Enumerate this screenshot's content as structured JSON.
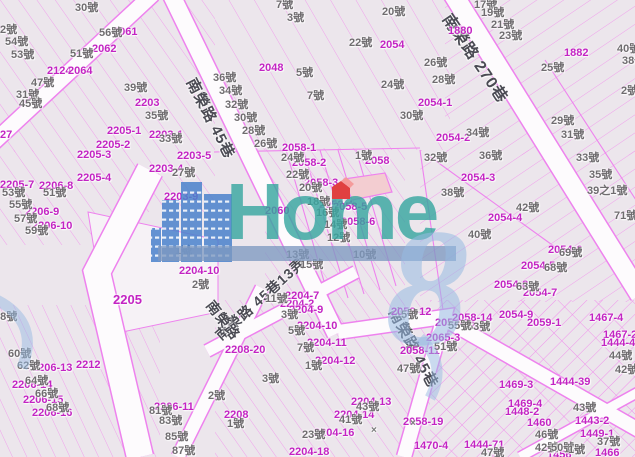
{
  "map": {
    "colors": {
      "background": "#ece6ec",
      "parcel_line": "#f0a0ec",
      "road_edge": "#ee82ee",
      "road_fill": "#fdfbfd",
      "parcel_label": "#c324c3",
      "house_label": "#6f6c6f",
      "street_label": "#4b4b54",
      "marker_red": "#e04040",
      "highlight_parcel_fill": "#f3cdd1"
    },
    "watermark": {
      "text": "Home",
      "numeral": "8",
      "text_color": "rgba(56,166,160,0.82)",
      "bar_color": "rgba(125,152,192,0.78)",
      "numeral_color": "rgba(152,186,226,0.55)",
      "building_color": "#4a82cc"
    },
    "street_labels": [
      {
        "text": "南榮路 45巷",
        "x": 197,
        "y": 76,
        "rot": 63,
        "size": 15
      },
      {
        "text": "南榮路 270巷",
        "x": 452,
        "y": 12,
        "rot": 56,
        "size": 16
      },
      {
        "text": "南榮路 45巷13弄",
        "x": 213,
        "y": 332,
        "rot": -42,
        "size": 14
      },
      {
        "text": "南榮路",
        "x": 215,
        "y": 298,
        "rot": 52,
        "size": 14
      },
      {
        "text": "南榮路 45巷",
        "x": 399,
        "y": 306,
        "rot": 62,
        "size": 15
      }
    ],
    "parcel_labels": [
      {
        "text": "2061",
        "x": 113,
        "y": 27
      },
      {
        "text": "2062",
        "x": 92,
        "y": 44
      },
      {
        "text": "2124",
        "x": 47,
        "y": 66
      },
      {
        "text": "2064",
        "x": 68,
        "y": 66
      },
      {
        "text": "2203",
        "x": 135,
        "y": 98
      },
      {
        "text": "2205-1",
        "x": 107,
        "y": 126
      },
      {
        "text": "2203-1",
        "x": 149,
        "y": 130
      },
      {
        "text": "2205-2",
        "x": 96,
        "y": 140
      },
      {
        "text": "27",
        "x": 0,
        "y": 130
      },
      {
        "text": "2048",
        "x": 259,
        "y": 63
      },
      {
        "text": "2054",
        "x": 380,
        "y": 40
      },
      {
        "text": "2054-1",
        "x": 418,
        "y": 98
      },
      {
        "text": "2058-1",
        "x": 282,
        "y": 143
      },
      {
        "text": "1880",
        "x": 448,
        "y": 26
      },
      {
        "text": "1882",
        "x": 564,
        "y": 48
      },
      {
        "text": "2054-2",
        "x": 436,
        "y": 133
      },
      {
        "text": "2054-3",
        "x": 461,
        "y": 173
      },
      {
        "text": "2054-4",
        "x": 488,
        "y": 213
      },
      {
        "text": "2054-6",
        "x": 548,
        "y": 245
      },
      {
        "text": "2054-5",
        "x": 521,
        "y": 261
      },
      {
        "text": "2054-8",
        "x": 494,
        "y": 280
      },
      {
        "text": "2054-7",
        "x": 523,
        "y": 288
      },
      {
        "text": "2205-3",
        "x": 77,
        "y": 150
      },
      {
        "text": "2205-4",
        "x": 77,
        "y": 173
      },
      {
        "text": "2205-7",
        "x": 0,
        "y": 180
      },
      {
        "text": "2206-8",
        "x": 39,
        "y": 181
      },
      {
        "text": "2206-9",
        "x": 25,
        "y": 207
      },
      {
        "text": "2206-10",
        "x": 32,
        "y": 221
      },
      {
        "text": "2203-4",
        "x": 149,
        "y": 164
      },
      {
        "text": "2203-5",
        "x": 177,
        "y": 151
      },
      {
        "text": "2203-9",
        "x": 164,
        "y": 192
      },
      {
        "text": "2058-2",
        "x": 292,
        "y": 158
      },
      {
        "text": "2058-3",
        "x": 304,
        "y": 178
      },
      {
        "text": "2058-4",
        "x": 319,
        "y": 200
      },
      {
        "text": "2058-5",
        "x": 333,
        "y": 202
      },
      {
        "text": "2058-6",
        "x": 341,
        "y": 217
      },
      {
        "text": "2058",
        "x": 365,
        "y": 156
      },
      {
        "text": "2060",
        "x": 265,
        "y": 206
      },
      {
        "text": "2204-10",
        "x": 179,
        "y": 266
      },
      {
        "text": "2205",
        "x": 113,
        "y": 293,
        "size": 13
      },
      {
        "text": "2212",
        "x": 76,
        "y": 360
      },
      {
        "text": "2206-13",
        "x": 32,
        "y": 363
      },
      {
        "text": "2206-14",
        "x": 12,
        "y": 380
      },
      {
        "text": "2206-15",
        "x": 23,
        "y": 395
      },
      {
        "text": "2206-16",
        "x": 32,
        "y": 408
      },
      {
        "text": "2206-11",
        "x": 154,
        "y": 402
      },
      {
        "text": "2208-20",
        "x": 225,
        "y": 345
      },
      {
        "text": "2208",
        "x": 224,
        "y": 410
      },
      {
        "text": "2204-2",
        "x": 280,
        "y": 299
      },
      {
        "text": "2204-7",
        "x": 285,
        "y": 291
      },
      {
        "text": "2204-9",
        "x": 289,
        "y": 305
      },
      {
        "text": "2204-10",
        "x": 297,
        "y": 321
      },
      {
        "text": "2204-11",
        "x": 307,
        "y": 338
      },
      {
        "text": "2204-12",
        "x": 315,
        "y": 356
      },
      {
        "text": "2204-13",
        "x": 351,
        "y": 397
      },
      {
        "text": "2204-14",
        "x": 334,
        "y": 410
      },
      {
        "text": "2204-16",
        "x": 314,
        "y": 428
      },
      {
        "text": "2204-18",
        "x": 289,
        "y": 447
      },
      {
        "text": "2058-19",
        "x": 403,
        "y": 417
      },
      {
        "text": "2058-12",
        "x": 391,
        "y": 307
      },
      {
        "text": "2058-13",
        "x": 435,
        "y": 318
      },
      {
        "text": "2058-14",
        "x": 452,
        "y": 313
      },
      {
        "text": "2058-11",
        "x": 400,
        "y": 346
      },
      {
        "text": "2065-3",
        "x": 426,
        "y": 333
      },
      {
        "text": "2054-9",
        "x": 499,
        "y": 310
      },
      {
        "text": "2059-1",
        "x": 527,
        "y": 318
      },
      {
        "text": "1467-4",
        "x": 589,
        "y": 313
      },
      {
        "text": "1467-2",
        "x": 603,
        "y": 330
      },
      {
        "text": "1444-4",
        "x": 601,
        "y": 338
      },
      {
        "text": "1469-3",
        "x": 499,
        "y": 380
      },
      {
        "text": "1444-39",
        "x": 550,
        "y": 377
      },
      {
        "text": "1469-4",
        "x": 508,
        "y": 399
      },
      {
        "text": "1448-2",
        "x": 505,
        "y": 407
      },
      {
        "text": "1460",
        "x": 527,
        "y": 418
      },
      {
        "text": "1443-2",
        "x": 575,
        "y": 416
      },
      {
        "text": "1449-1",
        "x": 580,
        "y": 429
      },
      {
        "text": "1444-71",
        "x": 464,
        "y": 440
      },
      {
        "text": "1470-4",
        "x": 414,
        "y": 441
      },
      {
        "text": "1456",
        "x": 547,
        "y": 450
      },
      {
        "text": "1466",
        "x": 595,
        "y": 448
      }
    ],
    "house_labels": [
      {
        "text": "30號",
        "x": 75,
        "y": 3
      },
      {
        "text": "2號",
        "x": 0,
        "y": 25
      },
      {
        "text": "54號",
        "x": 5,
        "y": 37
      },
      {
        "text": "53號",
        "x": 11,
        "y": 50
      },
      {
        "text": "56號",
        "x": 99,
        "y": 28
      },
      {
        "text": "51號",
        "x": 70,
        "y": 49
      },
      {
        "text": "47號",
        "x": 31,
        "y": 78
      },
      {
        "text": "31號",
        "x": 16,
        "y": 90
      },
      {
        "text": "45號",
        "x": 19,
        "y": 99
      },
      {
        "text": "39號",
        "x": 124,
        "y": 83
      },
      {
        "text": "35號",
        "x": 145,
        "y": 111
      },
      {
        "text": "33號",
        "x": 159,
        "y": 134
      },
      {
        "text": "27號",
        "x": 172,
        "y": 168
      },
      {
        "text": "7號",
        "x": 276,
        "y": 0
      },
      {
        "text": "3號",
        "x": 287,
        "y": 13
      },
      {
        "text": "20號",
        "x": 382,
        "y": 7
      },
      {
        "text": "22號",
        "x": 349,
        "y": 38
      },
      {
        "text": "26號",
        "x": 424,
        "y": 58
      },
      {
        "text": "24號",
        "x": 381,
        "y": 80
      },
      {
        "text": "28號",
        "x": 432,
        "y": 75
      },
      {
        "text": "30號",
        "x": 400,
        "y": 111
      },
      {
        "text": "5號",
        "x": 296,
        "y": 68
      },
      {
        "text": "7號",
        "x": 307,
        "y": 91
      },
      {
        "text": "36號",
        "x": 213,
        "y": 73
      },
      {
        "text": "34號",
        "x": 219,
        "y": 86
      },
      {
        "text": "32號",
        "x": 225,
        "y": 100
      },
      {
        "text": "30號",
        "x": 234,
        "y": 113
      },
      {
        "text": "28號",
        "x": 242,
        "y": 126
      },
      {
        "text": "26號",
        "x": 254,
        "y": 139
      },
      {
        "text": "17號",
        "x": 474,
        "y": 0
      },
      {
        "text": "19號",
        "x": 481,
        "y": 8
      },
      {
        "text": "21號",
        "x": 491,
        "y": 20
      },
      {
        "text": "23號",
        "x": 499,
        "y": 31
      },
      {
        "text": "25號",
        "x": 541,
        "y": 63
      },
      {
        "text": "34號",
        "x": 466,
        "y": 128
      },
      {
        "text": "29號",
        "x": 551,
        "y": 116
      },
      {
        "text": "31號",
        "x": 561,
        "y": 130
      },
      {
        "text": "33號",
        "x": 576,
        "y": 153
      },
      {
        "text": "35號",
        "x": 589,
        "y": 170
      },
      {
        "text": "39之1號",
        "x": 587,
        "y": 186
      },
      {
        "text": "71號",
        "x": 614,
        "y": 211
      },
      {
        "text": "2號",
        "x": 621,
        "y": 86
      },
      {
        "text": "40號",
        "x": 617,
        "y": 44
      },
      {
        "text": "38號",
        "x": 622,
        "y": 56
      },
      {
        "text": "32號",
        "x": 424,
        "y": 153
      },
      {
        "text": "36號",
        "x": 479,
        "y": 151
      },
      {
        "text": "38號",
        "x": 441,
        "y": 188
      },
      {
        "text": "42號",
        "x": 516,
        "y": 203
      },
      {
        "text": "40號",
        "x": 468,
        "y": 230
      },
      {
        "text": "69號",
        "x": 559,
        "y": 248
      },
      {
        "text": "68號",
        "x": 544,
        "y": 263
      },
      {
        "text": "63號",
        "x": 516,
        "y": 282
      },
      {
        "text": "53號",
        "x": 2,
        "y": 188
      },
      {
        "text": "51號",
        "x": 43,
        "y": 188
      },
      {
        "text": "55號",
        "x": 9,
        "y": 200
      },
      {
        "text": "57號",
        "x": 14,
        "y": 214
      },
      {
        "text": "59號",
        "x": 25,
        "y": 226
      },
      {
        "text": "1號",
        "x": 355,
        "y": 151
      },
      {
        "text": "24號",
        "x": 281,
        "y": 153
      },
      {
        "text": "22號",
        "x": 286,
        "y": 170
      },
      {
        "text": "20號",
        "x": 299,
        "y": 183
      },
      {
        "text": "18號",
        "x": 307,
        "y": 197
      },
      {
        "text": "16號",
        "x": 316,
        "y": 208
      },
      {
        "text": "14號",
        "x": 324,
        "y": 220
      },
      {
        "text": "12號",
        "x": 327,
        "y": 233
      },
      {
        "text": "10號",
        "x": 353,
        "y": 250
      },
      {
        "text": "13號",
        "x": 286,
        "y": 250
      },
      {
        "text": "15號",
        "x": 300,
        "y": 260
      },
      {
        "text": "1號",
        "x": 175,
        "y": 246
      },
      {
        "text": "2號",
        "x": 192,
        "y": 280
      },
      {
        "text": "2號",
        "x": 208,
        "y": 391
      },
      {
        "text": "3號",
        "x": 262,
        "y": 374
      },
      {
        "text": "1號",
        "x": 227,
        "y": 419
      },
      {
        "text": "11號",
        "x": 265,
        "y": 294
      },
      {
        "text": "3號",
        "x": 281,
        "y": 310
      },
      {
        "text": "5號",
        "x": 288,
        "y": 326
      },
      {
        "text": "7號",
        "x": 297,
        "y": 343
      },
      {
        "text": "1號",
        "x": 305,
        "y": 361
      },
      {
        "text": "43號",
        "x": 356,
        "y": 402
      },
      {
        "text": "41號",
        "x": 339,
        "y": 415
      },
      {
        "text": "23號",
        "x": 302,
        "y": 430
      },
      {
        "text": "58號",
        "x": -6,
        "y": 312
      },
      {
        "text": "60號",
        "x": 8,
        "y": 349
      },
      {
        "text": "62號",
        "x": 17,
        "y": 361
      },
      {
        "text": "64號",
        "x": 25,
        "y": 376
      },
      {
        "text": "66號",
        "x": 35,
        "y": 389
      },
      {
        "text": "68號",
        "x": 46,
        "y": 403
      },
      {
        "text": "81號",
        "x": 149,
        "y": 406
      },
      {
        "text": "83號",
        "x": 159,
        "y": 416
      },
      {
        "text": "85號",
        "x": 165,
        "y": 432
      },
      {
        "text": "87號",
        "x": 172,
        "y": 446
      },
      {
        "text": "53號",
        "x": 467,
        "y": 322
      },
      {
        "text": "55號",
        "x": 448,
        "y": 321
      },
      {
        "text": "5號",
        "x": 401,
        "y": 310
      },
      {
        "text": "51號",
        "x": 434,
        "y": 342
      },
      {
        "text": "47號",
        "x": 397,
        "y": 364
      },
      {
        "text": "44號",
        "x": 609,
        "y": 351
      },
      {
        "text": "42號",
        "x": 615,
        "y": 365
      },
      {
        "text": "43號",
        "x": 573,
        "y": 403
      },
      {
        "text": "46號",
        "x": 535,
        "y": 430
      },
      {
        "text": "37號",
        "x": 597,
        "y": 437
      },
      {
        "text": "42號",
        "x": 535,
        "y": 443
      },
      {
        "text": "50號",
        "x": 551,
        "y": 443
      },
      {
        "text": "1號",
        "x": 568,
        "y": 445
      },
      {
        "text": "47號",
        "x": 481,
        "y": 448
      }
    ],
    "marks": [
      {
        "text": "×",
        "x": 371,
        "y": 426
      },
      {
        "text": "×",
        "x": 410,
        "y": 419
      }
    ]
  }
}
